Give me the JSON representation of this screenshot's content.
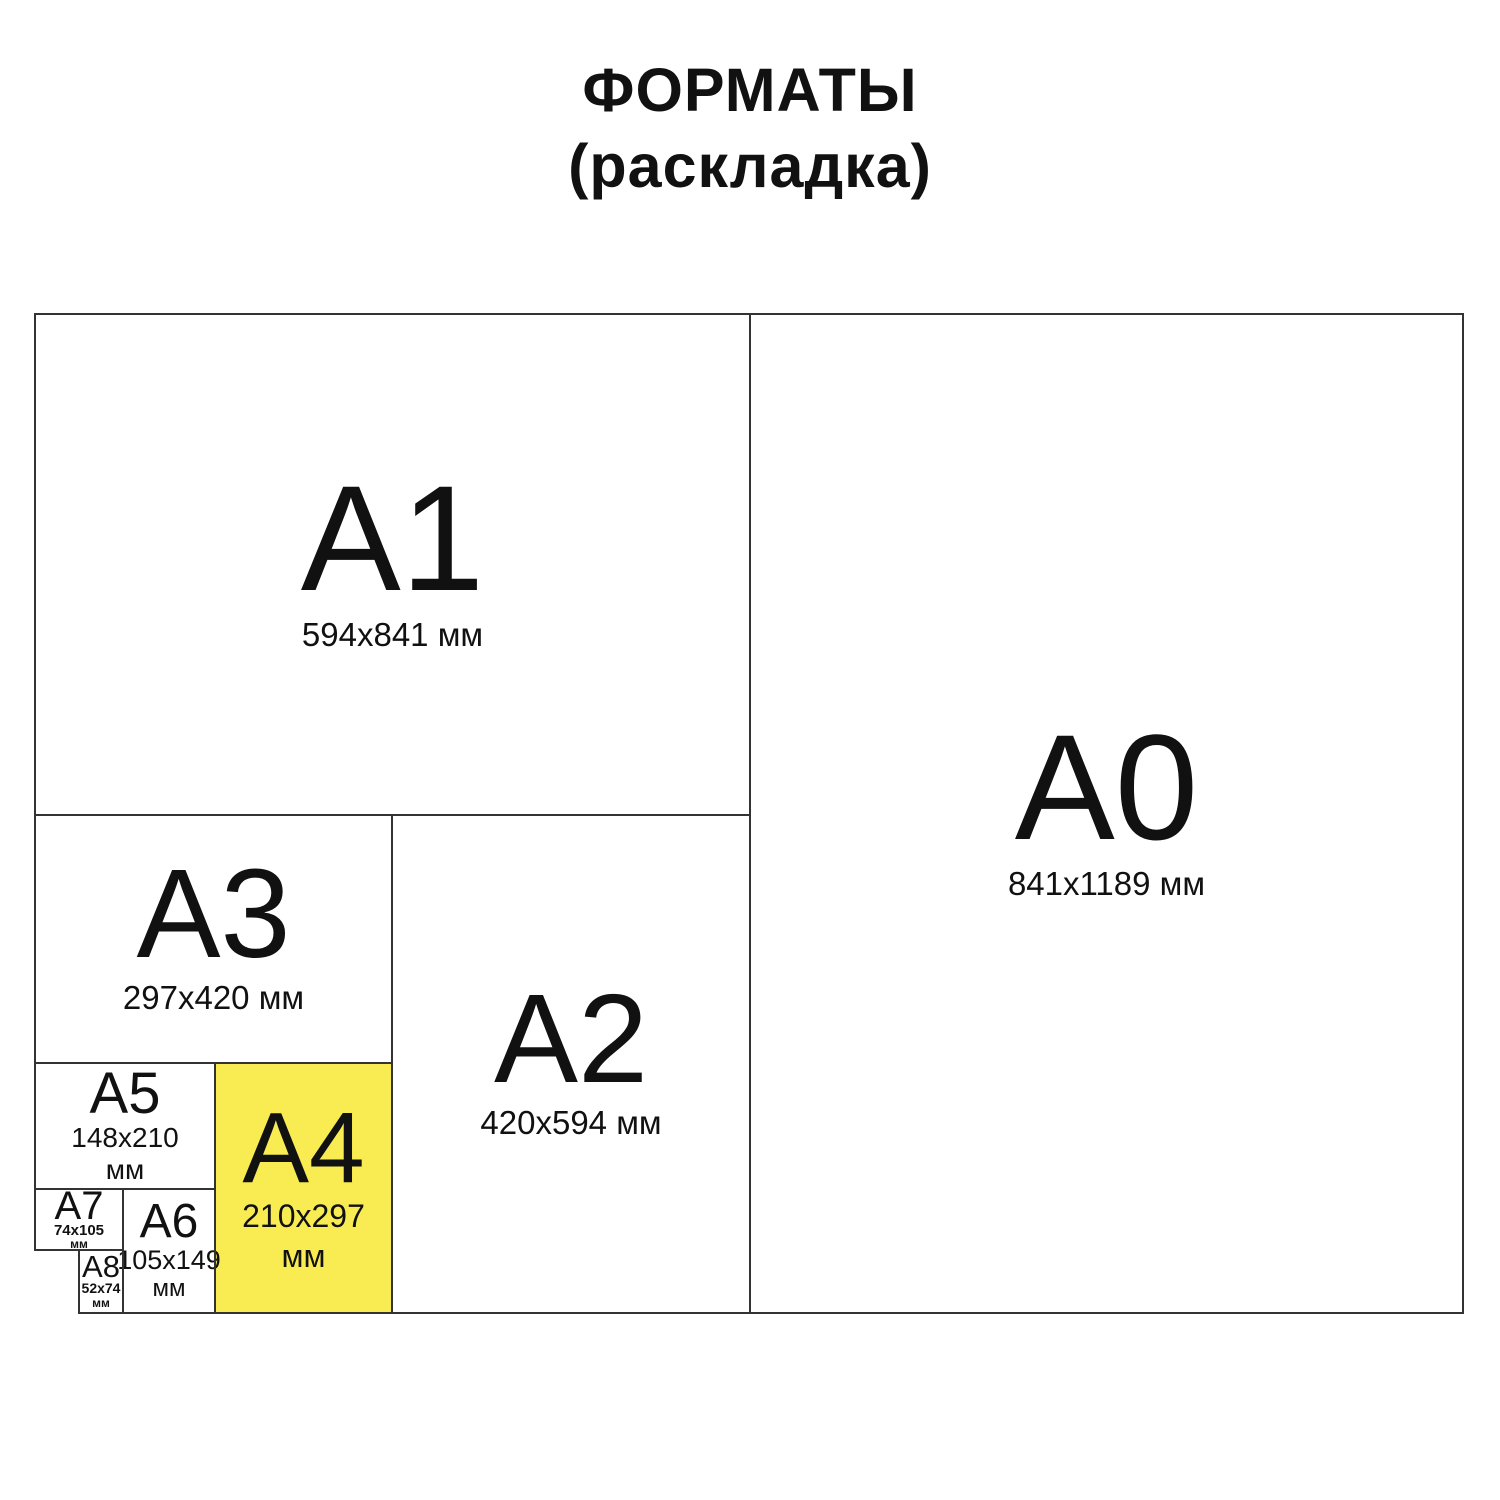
{
  "title": {
    "line1": "ФОРМАТЫ",
    "line2": "(раскладка)"
  },
  "colors": {
    "highlight": "#F8EC52",
    "line": "#333333",
    "text": "#111111",
    "canvas": "#FFFFFF"
  },
  "formats": {
    "a0": {
      "label": "A0",
      "size": "841x1189 мм"
    },
    "a1": {
      "label": "A1",
      "size": "594x841 мм"
    },
    "a2": {
      "label": "A2",
      "size": "420x594 мм"
    },
    "a3": {
      "label": "A3",
      "size": "297x420 мм"
    },
    "a4": {
      "label": "A4",
      "size": "210x297",
      "unit": "мм",
      "highlighted": true
    },
    "a5": {
      "label": "A5",
      "size": "148x210",
      "unit": "мм"
    },
    "a6": {
      "label": "A6",
      "size": "105x149",
      "unit": "мм"
    },
    "a7": {
      "label": "A7",
      "size": "74x105",
      "unit": "мм"
    },
    "a8": {
      "label": "A8",
      "size": "52x74",
      "unit": "мм"
    }
  }
}
